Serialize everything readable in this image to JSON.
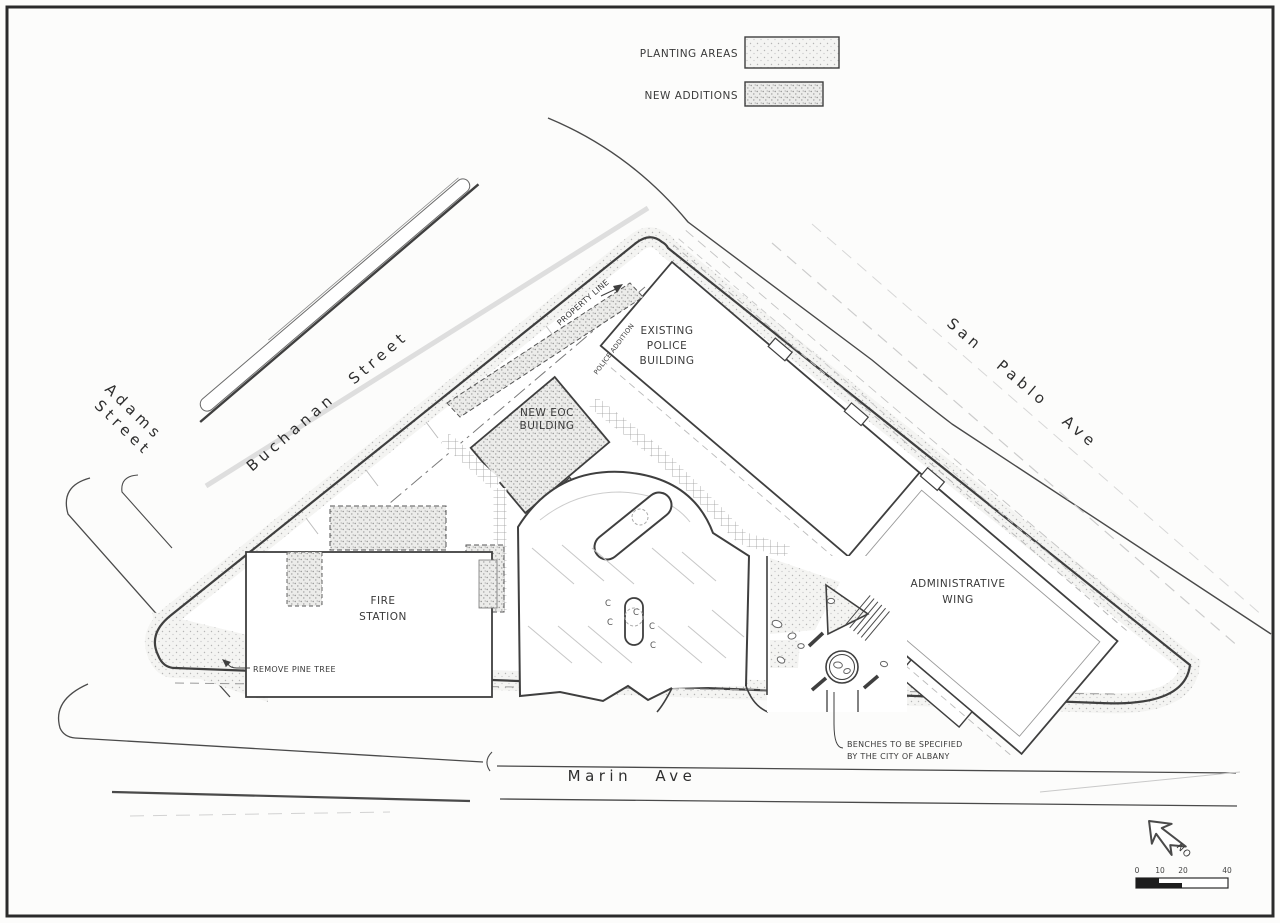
{
  "title": "Albany civic center site plan",
  "colors": {
    "paper": "#fcfcfb",
    "line_dark": "#3f3f3f",
    "line_light": "#b9b9b9",
    "stipple_light": "#b5b5b5",
    "stipple_dense": "#8f8f8f"
  },
  "legend": {
    "items": [
      {
        "label": "PLANTING AREAS",
        "swatch": "planting-areas-swatch"
      },
      {
        "label": "NEW ADDITIONS",
        "swatch": "new-additions-swatch"
      }
    ]
  },
  "streets": {
    "adams": {
      "line1": "Adams",
      "line2": "Street"
    },
    "buchanan": {
      "label": "Buchanan Street"
    },
    "san_pablo": {
      "label": "San Pablo Ave"
    },
    "marin": {
      "label": "Marin Ave"
    }
  },
  "buildings": {
    "police": {
      "line1": "EXISTING",
      "line2": "POLICE",
      "line3": "BUILDING"
    },
    "eoc": {
      "line1": "NEW EOC",
      "line2": "BUILDING"
    },
    "fire": {
      "line1": "FIRE",
      "line2": "STATION"
    },
    "admin": {
      "line1": "ADMINISTRATIVE",
      "line2": "WING"
    }
  },
  "annotations": {
    "property_line": "PROPERTY LINE",
    "police_addition": "POLICE ADDITION",
    "remove_pine_tree": "REMOVE PINE TREE",
    "benches_line1": "BENCHES TO BE SPECIFIED",
    "benches_line2": "BY THE CITY OF ALBANY",
    "parking_stall": "C"
  },
  "compass": {
    "label": "NO"
  },
  "scale_bar": {
    "ticks": [
      "0",
      "10",
      "20",
      "40"
    ]
  }
}
